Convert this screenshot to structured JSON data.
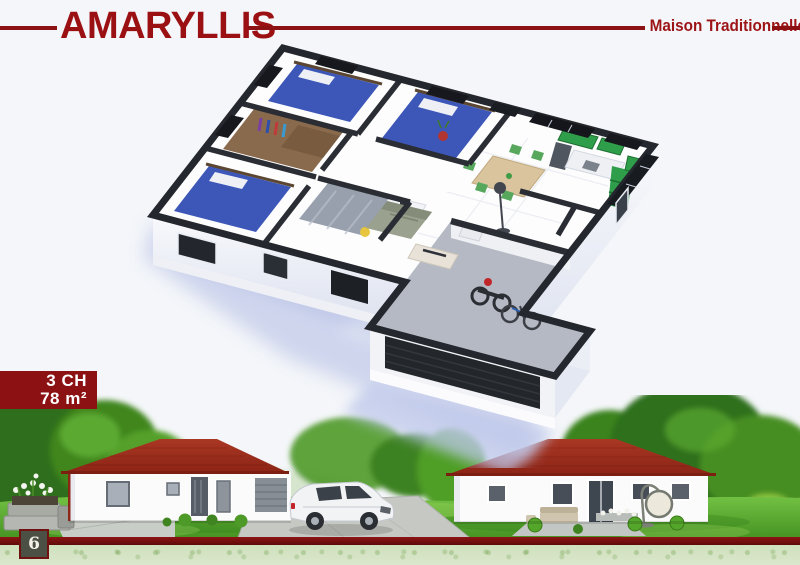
{
  "page": {
    "width": 800,
    "height": 565,
    "background": "#f4f6f9"
  },
  "header": {
    "title": "AMARYLLIS",
    "subtitle": "Maison Traditionnelle",
    "title_color": "#9b1113",
    "rule_color": "#8c1113"
  },
  "badge": {
    "rooms": "3 CH",
    "area": "78 m²",
    "background": "#8b1113",
    "text_color": "#ffffff"
  },
  "plan": {
    "wall_color": "#24272d",
    "floor_color": "#fdfdfe",
    "garage_floor_color": "#b5b9c3",
    "shadow_color": "#c8d0ec",
    "bed_color": "#3d57b8",
    "kitchen_color": "#2f9e4a"
  },
  "scene": {
    "roof_color": "#a23120",
    "house_wall_color": "#fbfbfc",
    "lawn_color": "#5fae2e"
  },
  "footer": {
    "page_number": "6",
    "rule_color": "#7a0f10",
    "strip_color": "#d3e2c2"
  }
}
